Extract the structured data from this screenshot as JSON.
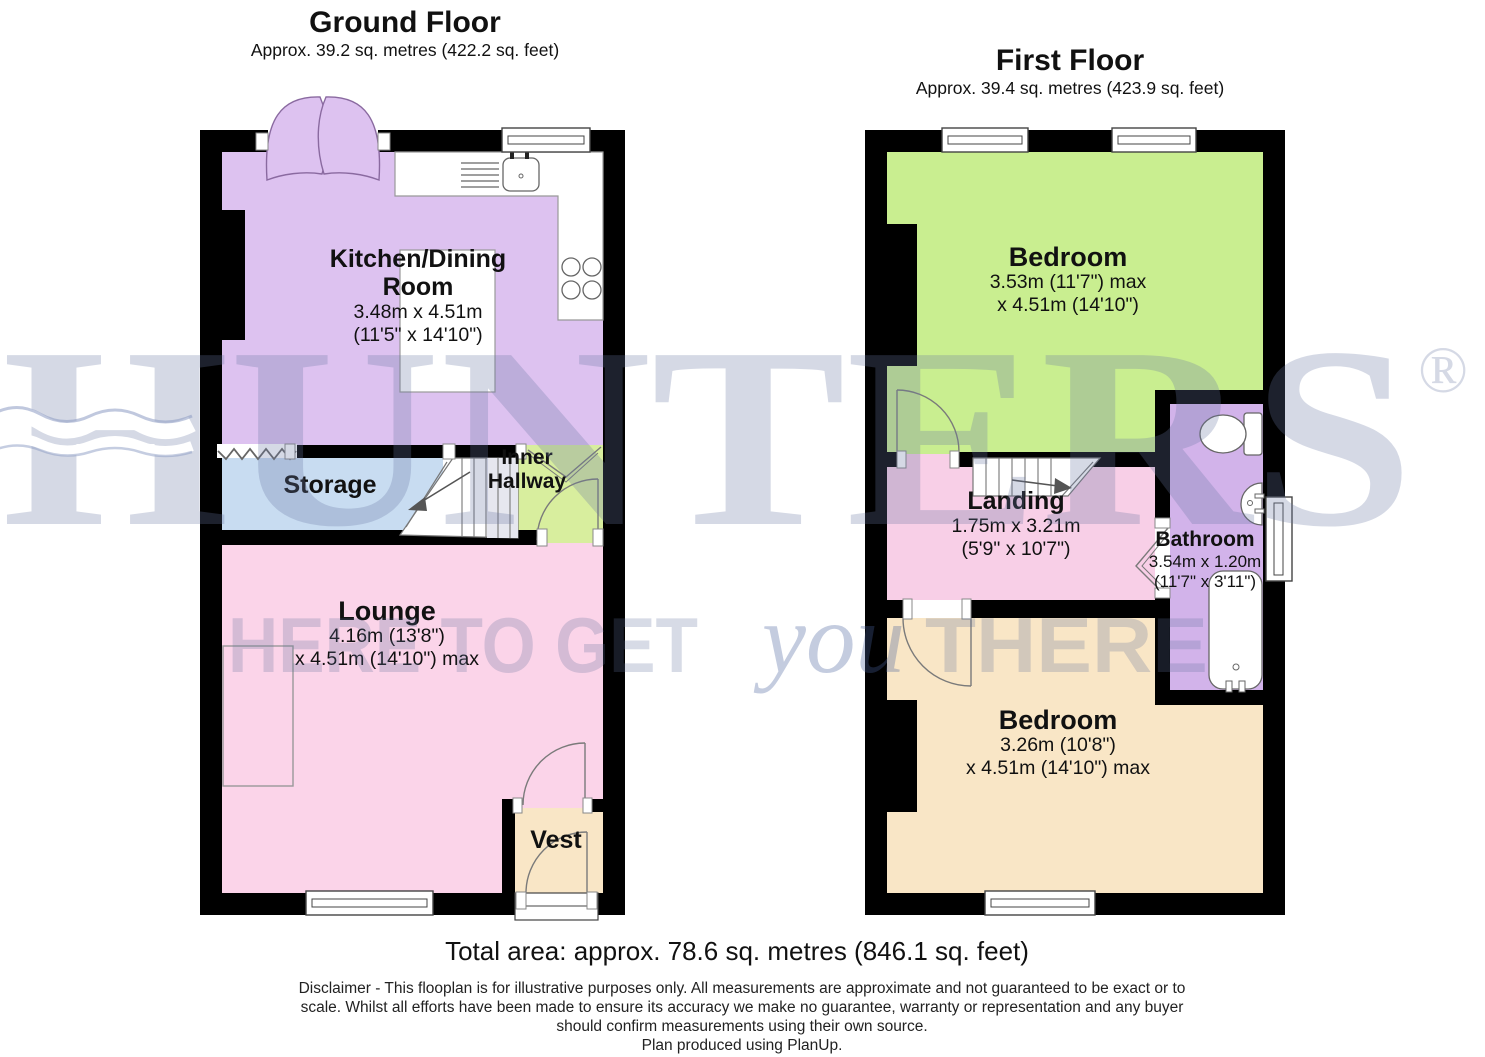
{
  "ground_floor": {
    "title": "Ground Floor",
    "subtitle": "Approx. 39.2 sq. metres (422.2 sq. feet)",
    "rooms": {
      "kitchen": {
        "name1": "Kitchen/Dining",
        "name2": "Room",
        "dim1": "3.48m x 4.51m",
        "dim2": "(11'5\" x 14'10\")"
      },
      "storage": {
        "name": "Storage"
      },
      "inner_hallway": {
        "name1": "Inner",
        "name2": "Hallway"
      },
      "lounge": {
        "name": "Lounge",
        "dim1": "4.16m (13'8\")",
        "dim2": "x 4.51m (14'10\") max"
      },
      "vest": {
        "name": "Vest"
      }
    }
  },
  "first_floor": {
    "title": "First Floor",
    "subtitle": "Approx. 39.4 sq. metres (423.9 sq. feet)",
    "rooms": {
      "bedroom1": {
        "name": "Bedroom",
        "dim1": "3.53m (11'7\") max",
        "dim2": "x 4.51m (14'10\")"
      },
      "landing": {
        "name": "Landing",
        "dim1": "1.75m x 3.21m",
        "dim2": "(5'9\" x 10'7\")"
      },
      "bathroom": {
        "name": "Bathroom",
        "dim1": "3.54m x 1.20m",
        "dim2": "(11'7\" x 3'11\")"
      },
      "bedroom2": {
        "name": "Bedroom",
        "dim1": "3.26m (10'8\")",
        "dim2": "x 4.51m (14'10\") max"
      }
    }
  },
  "footer": {
    "total_area": "Total area: approx. 78.6 sq. metres (846.1 sq. feet)",
    "disclaimer1": "Disclaimer - This flooplan is for illustrative purposes only. All measurements are approximate and not guaranteed to be exact or to",
    "disclaimer2": "scale. Whilst all efforts have been made to ensure its accuracy we make no guarantee, warranty or representation and any buyer",
    "disclaimer3": "should confirm measurements using their own source.",
    "produced": "Plan produced using PlanUp."
  },
  "watermark": {
    "brand": "HUNTERS",
    "registered": "®",
    "slogan_pre": "HERE TO GET",
    "slogan_script": "you",
    "slogan_post": "THERE",
    "brand_color": "rgba(103,117,161,0.28)",
    "slogan_color": "rgba(96,112,156,0.25)",
    "script_color": "rgba(73,97,156,0.32)"
  },
  "colors": {
    "wall": "#000000",
    "kitchen": "#ddc2f0",
    "storage": "#c8dcf1",
    "inner_hallway": "#d8ee9e",
    "lounge": "#fbd4e9",
    "landing": "#f8cfe7",
    "vest": "#f9e6c6",
    "bedroom1": "#c9ee90",
    "bedroom2": "#f9e6c6",
    "bathroom": "#d2b3ea"
  }
}
